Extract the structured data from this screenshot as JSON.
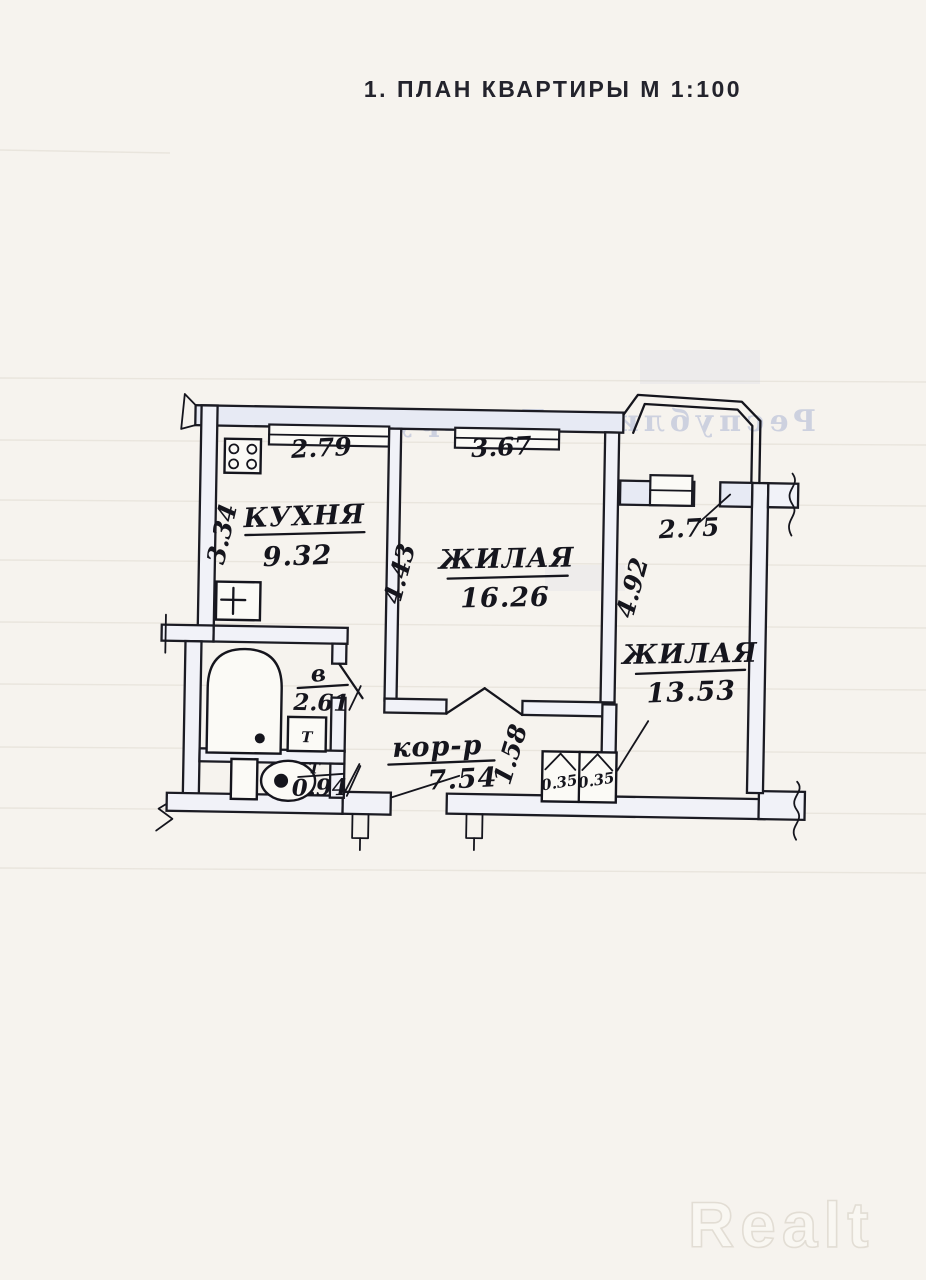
{
  "page": {
    "title": "1. ПЛАН КВАРТИРЫ М 1:100",
    "paper_watermark": "Республика Беларусь",
    "brand_watermark": "Realt"
  },
  "plan": {
    "rooms": {
      "kitchen": {
        "label": "КУХНЯ",
        "area": "9.32"
      },
      "living_room_1": {
        "label": "ЖИЛАЯ",
        "area": "16.26"
      },
      "living_room_2": {
        "label": "ЖИЛАЯ",
        "area": "13.53"
      },
      "bathroom": {
        "label": "в",
        "area": "2.61"
      },
      "wc": {
        "label": "Т",
        "area": "0.94"
      },
      "corridor": {
        "label": "кор-р",
        "area": "7.54"
      }
    },
    "dimensions": {
      "kitchen_width": "2.79",
      "kitchen_depth": "3.34",
      "living1_width": "3.67",
      "living1_depth": "4.43",
      "living2_depth": "4.92",
      "balcony_width": "2.75",
      "hall_width": "1.58",
      "closet_left": "0.35",
      "closet_right": "0.35"
    },
    "fixtures": {
      "heater_label": "Т"
    }
  },
  "colors": {
    "ink": "#15151d",
    "paper": "#f6f3ee",
    "wall_tint": "#e7eaf4",
    "watermark_blue": "#97a3cc"
  }
}
